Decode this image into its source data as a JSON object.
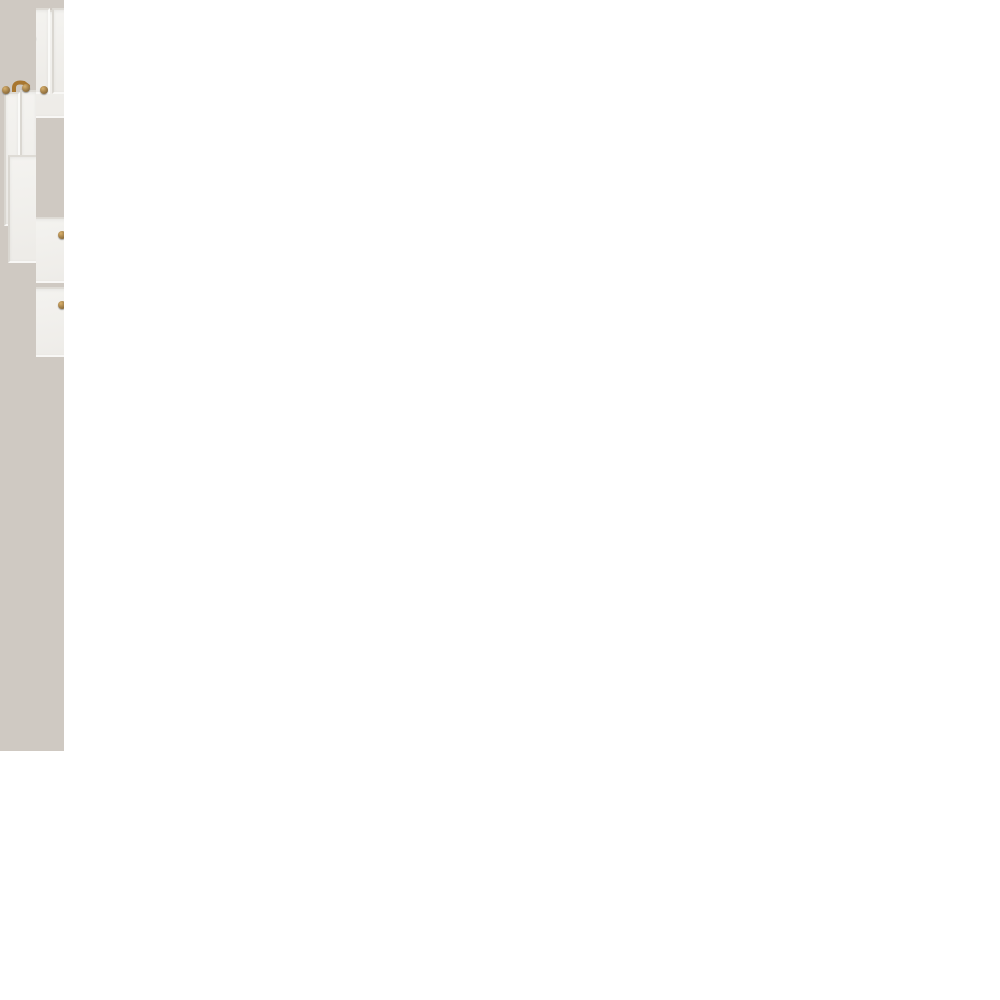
{
  "overlay": {
    "title": "Línea Vik",
    "lines": [
      "una cocina versátil",
      "para los más variados",
      "tipos de ambiente"
    ]
  },
  "photos": {
    "left": {
      "alt": "white-kitchen-glass-cabinet-fridge"
    },
    "top_right": {
      "alt": "white-kitchen-run-window-oven-dining-chairs"
    },
    "bottom_right": {
      "alt": "white-kitchen-window-island-copper-stool"
    }
  },
  "palette": {
    "cabinet_white": "#f4f3f0",
    "brass_knob": "#8a6a3a",
    "copper": "#bf7d45",
    "wood_floor_dark": "#96765c",
    "wood_floor_light": "#d9bd9b",
    "window_wood": "#8a6845",
    "overlay_background": "rgba(62,53,46,0.6)",
    "overlay_text": "#ffffff",
    "gap_white": "#ffffff"
  }
}
